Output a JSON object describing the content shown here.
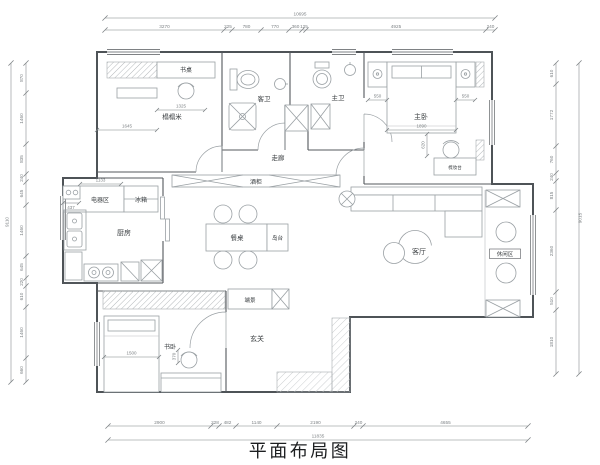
{
  "title": "平面布局图",
  "labels": {
    "study_desk": "书桌",
    "tatami": "榻榻米",
    "guest_bath": "客卫",
    "master_bath": "主卫",
    "master_bedroom": "主卧",
    "corridor": "走廊",
    "wine_cabinet": "酒柜",
    "appliance_area": "电器区",
    "fridge": "冰箱",
    "kitchen": "厨房",
    "dining_table": "餐桌",
    "island": "岛台",
    "living_room": "客厅",
    "leisure_area": "休闲区",
    "end_view": "端景",
    "entryway": "玄关",
    "study_bedroom": "书卧",
    "dressing_table": "梳妆台"
  },
  "dims": {
    "top": {
      "total": "10695",
      "segments": [
        "3270",
        "225",
        "780",
        "770",
        "360",
        "125",
        "4925",
        "240"
      ]
    },
    "left": {
      "total": "9110",
      "segments": [
        "870",
        "1460",
        "835",
        "240",
        "645",
        "1460",
        "645",
        "220",
        "610",
        "1460",
        "660"
      ]
    },
    "right": {
      "total": "9015",
      "segments": [
        "610",
        "1772",
        "760",
        "240",
        "815",
        "2360",
        "510",
        "1810"
      ]
    },
    "bottom": {
      "total": "11835",
      "segments": [
        "2900",
        "228",
        "482",
        "1140",
        "2190",
        "240",
        "4655"
      ]
    },
    "interior": {
      "tatami_width": "1645",
      "desk_width": "1325",
      "appliance_width": "1133",
      "appliance_side": "437",
      "bed_left": "550",
      "bed_right": "550",
      "bed_width": "1890",
      "bed_clearance": "620",
      "study_bed_length": "1500",
      "study_clearance": "370"
    }
  },
  "colors": {
    "wall": "#4e5357",
    "furniture": "#9aa0a4",
    "dimension": "#7d8285",
    "text": "#3c4043",
    "hatch": "#b4b8bb",
    "background": "#ffffff"
  }
}
